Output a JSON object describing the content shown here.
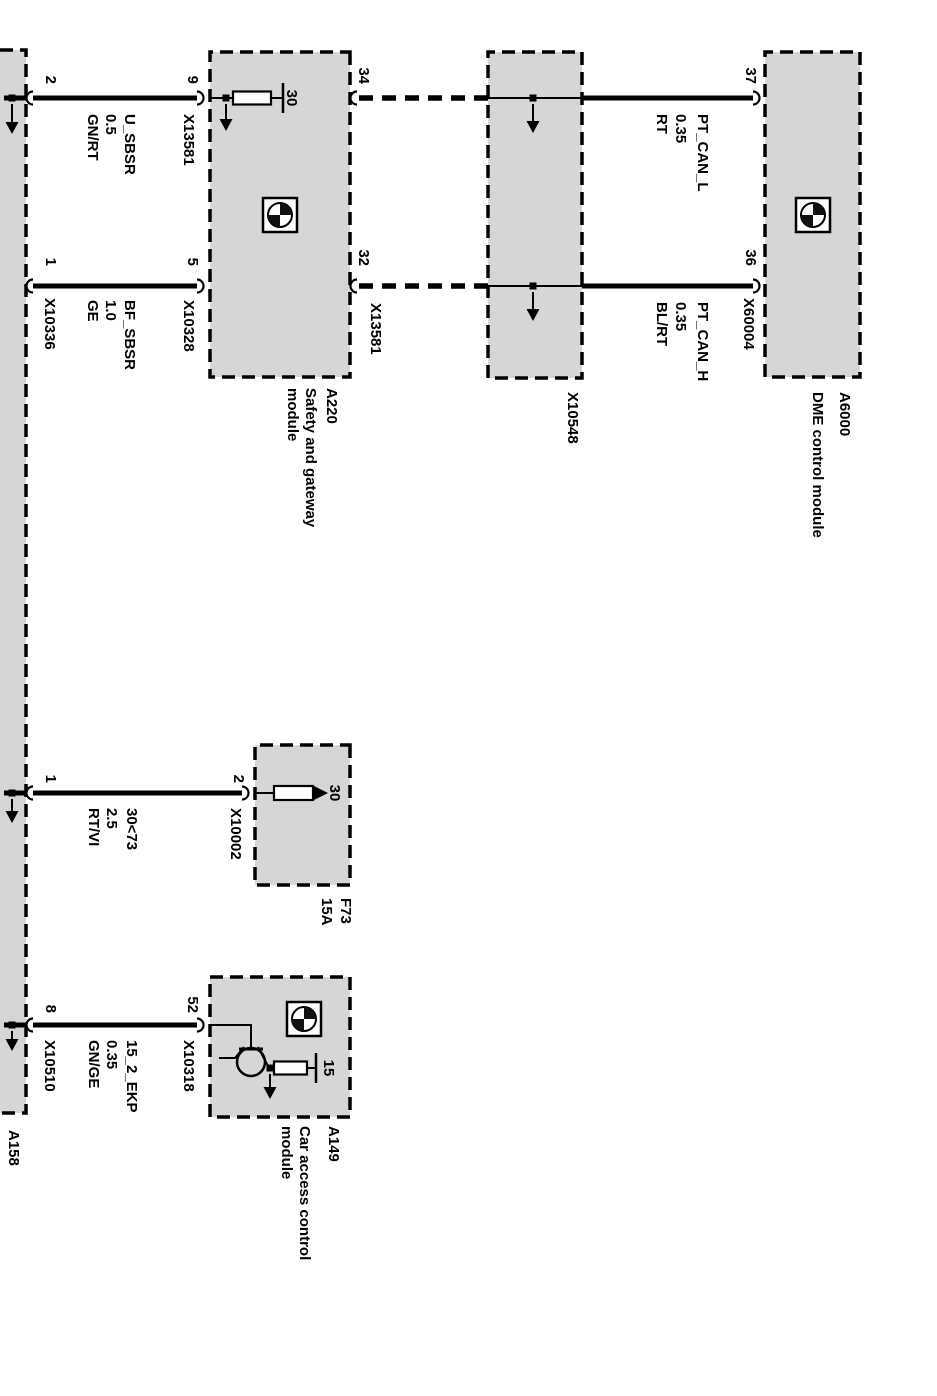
{
  "colors": {
    "background": "#ffffff",
    "module_fill": "#d6d6d6",
    "line": "#000000"
  },
  "modules": {
    "dme": {
      "id": "A6000",
      "name": "DME control module"
    },
    "gateway": {
      "id": "A220",
      "name_line1": "Safety and gateway",
      "name_line2": "module",
      "terminal": "30"
    },
    "cas": {
      "id": "A149",
      "name_line1": "Car access control",
      "name_line2": "module",
      "terminal": "15"
    },
    "fuse_f73": {
      "id": "F73",
      "rating": "15A",
      "terminal": "30"
    },
    "splice": {
      "id": "X10548"
    },
    "neighbor": {
      "id": "A158"
    }
  },
  "pins": {
    "dme_pt_can_l": "37",
    "dme_pt_can_h": "36",
    "gw_pt_can_l": "34",
    "gw_pt_can_h": "32",
    "gw_u_sbsr": "9",
    "gw_bf_sbsr": "5",
    "a158_u_sbsr": "2",
    "a158_bf_sbsr": "1",
    "f73_output": "2",
    "a158_kl30": "1",
    "cas_ekp": "52",
    "a158_ekp": "8"
  },
  "connectors": {
    "x13581_can": "X13581",
    "x13581_u": "X13581",
    "x10328": "X10328",
    "x10336": "X10336",
    "x60004": "X60004",
    "x10002": "X10002",
    "x10318": "X10318",
    "x10510": "X10510"
  },
  "wires": {
    "pt_can_l": {
      "name": "PT_CAN_L",
      "size": "0.35",
      "color": "RT"
    },
    "pt_can_h": {
      "name": "PT_CAN_H",
      "size": "0.35",
      "color": "BL/RT"
    },
    "u_sbsr": {
      "name": "U_SBSR",
      "size": "0.5",
      "color": "GN/RT"
    },
    "bf_sbsr": {
      "name": "BF_SBSR",
      "size": "1.0",
      "color": "GE"
    },
    "kl30_f73": {
      "name": "30<73",
      "size": "2.5",
      "color": "RT/VI"
    },
    "ekp_15_2": {
      "name": "15_2_EKP",
      "size": "0.35",
      "color": "GN/GE"
    }
  }
}
